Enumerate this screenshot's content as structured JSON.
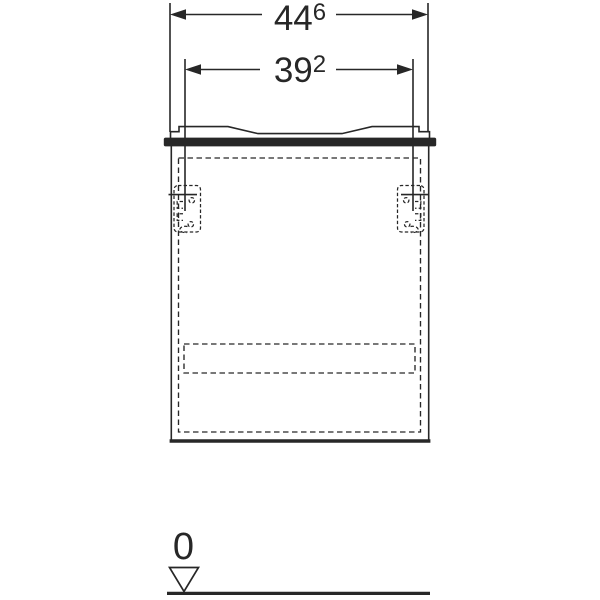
{
  "meta": {
    "background_color": "#ffffff",
    "line_color": "#272727",
    "drawing_kind": "furniture-front-view-dimension-drawing"
  },
  "drawing": {
    "dimensions": [
      {
        "id": "overall-width",
        "value": "44",
        "superscript": "6"
      },
      {
        "id": "bracket-spacing",
        "value": "39",
        "superscript": "2"
      }
    ],
    "datum": {
      "label": "0"
    }
  }
}
